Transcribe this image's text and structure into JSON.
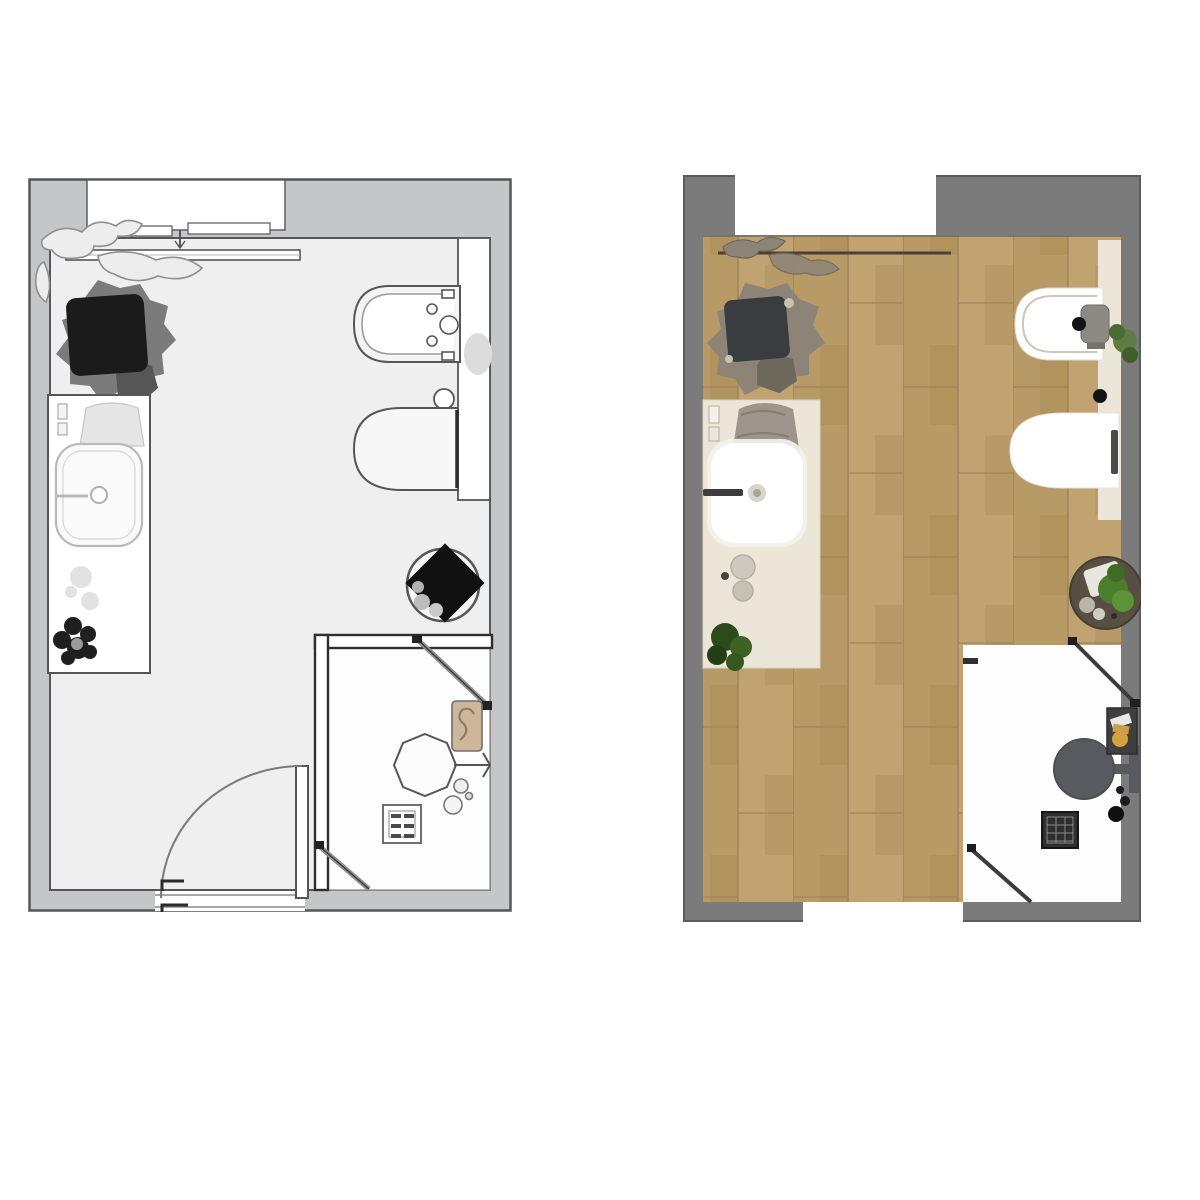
{
  "page": {
    "background": "#ffffff",
    "description": "two-bathroom-floor-plans-side-by-side"
  },
  "colors": {
    "page_bg": "#ffffff",
    "ink": "#555659",
    "wall_left": "#c5c6c8",
    "floor_left": "#efefef",
    "fixture_white": "#f7f7f7",
    "light_line": "#b9b9b9",
    "soft_gray": "#e2e2e2",
    "dark_plant": "#1b1b1b",
    "mid_gray": "#7b7b7b",
    "tan": "#cdb69a",
    "wall_right": "#7b7b7b",
    "wood_a": "#b79a66",
    "wood_b": "#c0a371",
    "wood_c": "#ab8d58",
    "wood_seam": "#a0855a",
    "cream": "#ece6d9",
    "towel_gray": "#9b958c",
    "stone_gray": "#8d8377",
    "dark_slate": "#3a3d3f",
    "green_dark": "#2c4a1a",
    "green_mid": "#4c7d2d",
    "green_light": "#5d9338",
    "pot_brown": "#564f42",
    "shower_metal": "#585a60",
    "shelf_dark": "#3f3f3f",
    "amber": "#d2a23c",
    "black": "#141414",
    "glass_line": "#3c3c3c"
  },
  "plans": {
    "left": {
      "kind": "schematic-line-floor-plan",
      "fixtures": [
        "window",
        "radiator",
        "hanging-plant",
        "potted-plant",
        "vanity-counter",
        "washbasin",
        "faucet",
        "towel",
        "soap-dishes",
        "dark-flower-object",
        "bidet",
        "flush-button",
        "toilet",
        "plumbing-panel",
        "wall-towel",
        "round-planter",
        "shower-enclosure",
        "glass-door-upper",
        "glass-door-lower",
        "shower-head",
        "shower-shelf",
        "shower-accessories",
        "floor-drain",
        "entry-door",
        "door-swing-arc",
        "door-handle"
      ]
    },
    "right": {
      "kind": "rendered-textured-floor-plan",
      "fixtures": [
        "window-opening",
        "wood-floor",
        "towel-rail",
        "hanging-plant",
        "potted-plant",
        "vanity-counter",
        "washbasin",
        "faucet",
        "towel",
        "cosmetic-bottles",
        "soap-dishes",
        "green-plant",
        "bidet",
        "bidet-faucet",
        "small-plant",
        "flush-button",
        "toilet",
        "plumbing-panel",
        "round-planter",
        "shower-floor",
        "glass-door-upper",
        "glass-door-lower",
        "rain-shower-head",
        "shower-arm",
        "shower-shelf",
        "floor-drain",
        "shower-accessories",
        "door-opening"
      ]
    }
  }
}
